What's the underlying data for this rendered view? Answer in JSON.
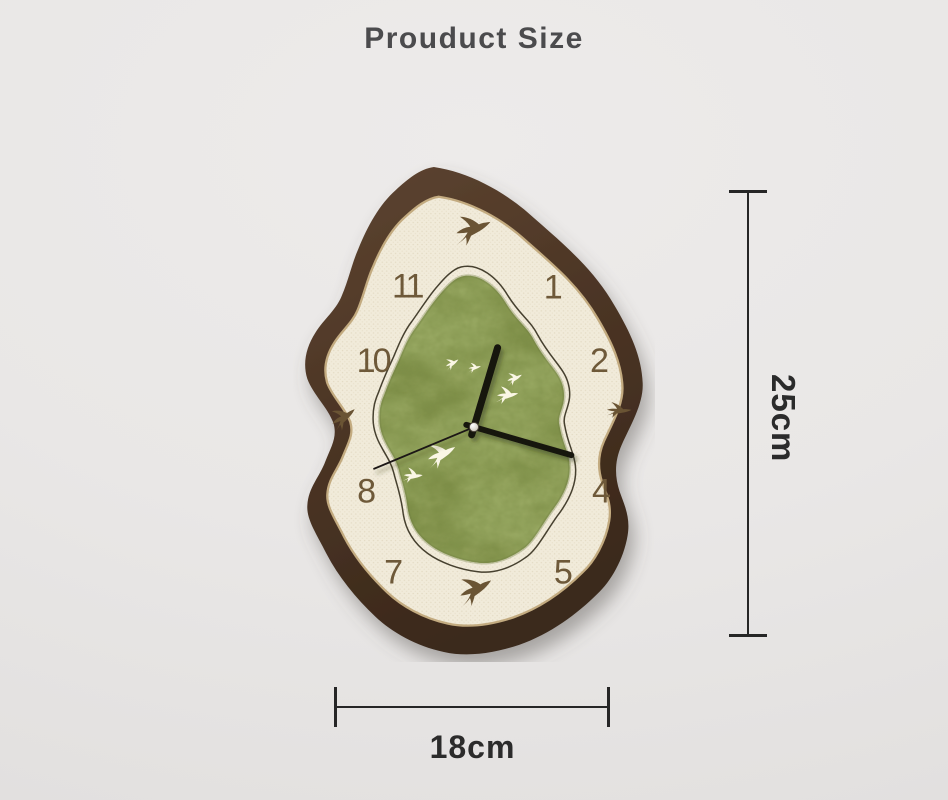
{
  "page": {
    "title": "Prouduct Size",
    "background_color": "#e9e7e6"
  },
  "clock": {
    "numerals": [
      {
        "value": "11"
      },
      {
        "value": "1"
      },
      {
        "value": "10"
      },
      {
        "value": "2"
      },
      {
        "value": "8"
      },
      {
        "value": "4"
      },
      {
        "value": "7"
      },
      {
        "value": "5"
      }
    ],
    "icons": {
      "hour_markers_12_3_6_9": "swallow-icon",
      "face_decorations": "white-swallow-icon",
      "white_swallow_count": 6
    },
    "colors": {
      "frame_wood_brown": "#4c3525",
      "face_cream": "#f1ebda",
      "face_gold_edge": "#c3ab80",
      "center_green": "#8b9a54",
      "numeral_brown": "#6e5939",
      "hand_black": "#15120e"
    }
  },
  "annotations": {
    "height": {
      "label": "25cm"
    },
    "width": {
      "label": "18cm"
    },
    "line_color": "#262626"
  }
}
